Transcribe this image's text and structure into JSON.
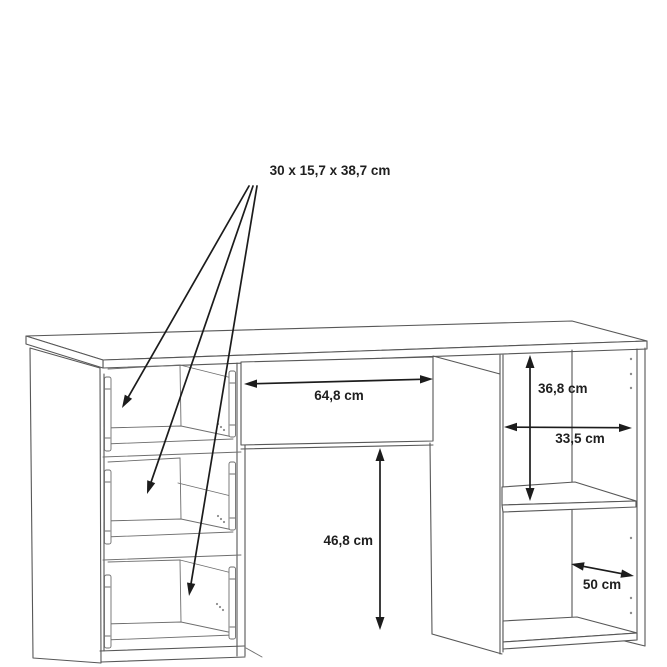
{
  "diagram": {
    "type": "furniture-dimension-line-drawing",
    "labels": {
      "drawer_size": "30 x 15,7 x 38,7 cm",
      "kneehole_width": "64,8 cm",
      "compartment_height": "36,8 cm",
      "compartment_width": "33,5 cm",
      "kneehole_height": "46,8 cm",
      "depth": "50 cm"
    },
    "colors": {
      "background": "#ffffff",
      "furniture_outline": "#575757",
      "dimension_ink": "#1c1c1c"
    }
  }
}
